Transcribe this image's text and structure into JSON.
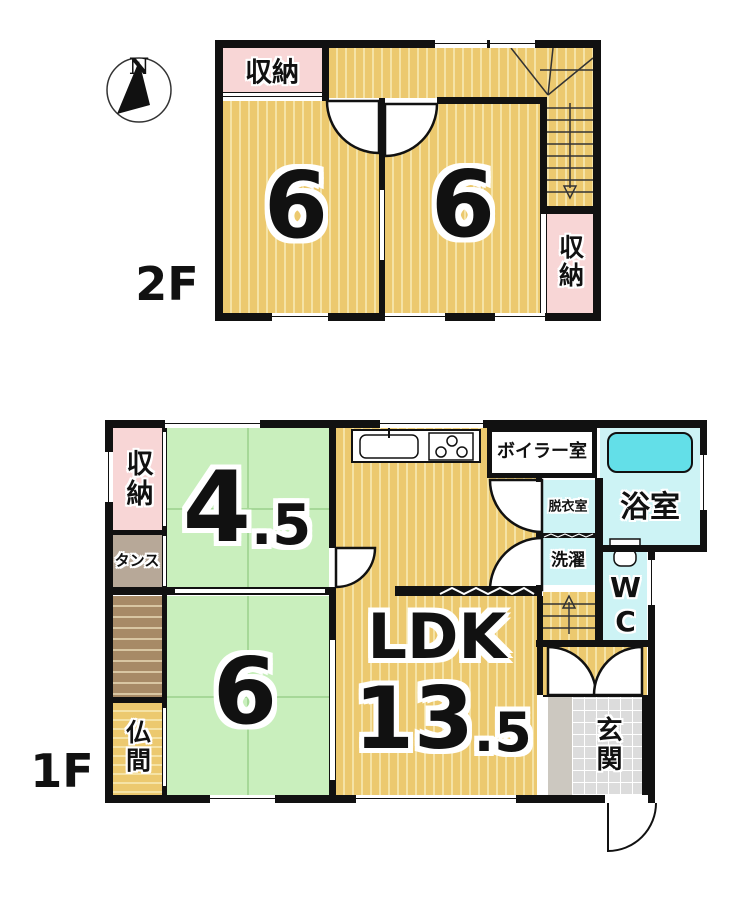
{
  "compass": {
    "north": "N"
  },
  "floor2": {
    "label": "2F",
    "closet_top": "収納",
    "room_left": "6",
    "room_right": "6",
    "closet_right": "収納"
  },
  "floor1": {
    "label": "1F",
    "closet": "収納",
    "tansu": "タンス",
    "room45_int": "4",
    "room45_frac": ".5",
    "room6": "6",
    "butsuma": "仏間",
    "ldk": "LDK",
    "ldk_int": "13",
    "ldk_frac": ".5",
    "boiler": "ボイラー室",
    "bath": "浴室",
    "dressing": "脱衣室",
    "laundry": "洗濯",
    "wc": "WC",
    "genkan": "玄関"
  },
  "colors": {
    "wall": "#111111",
    "tatami": "#ecc96f",
    "tatami_stripe": "#f5e3a6",
    "closet_pink": "#f8d6d6",
    "room_green": "#c9efbd",
    "wet_cyan": "#cdf3f5",
    "bathtub": "#63dfe8",
    "entry_tile": "#dcdcdc",
    "tansu": "#b7a898",
    "stair_brown": "#a78a66"
  }
}
